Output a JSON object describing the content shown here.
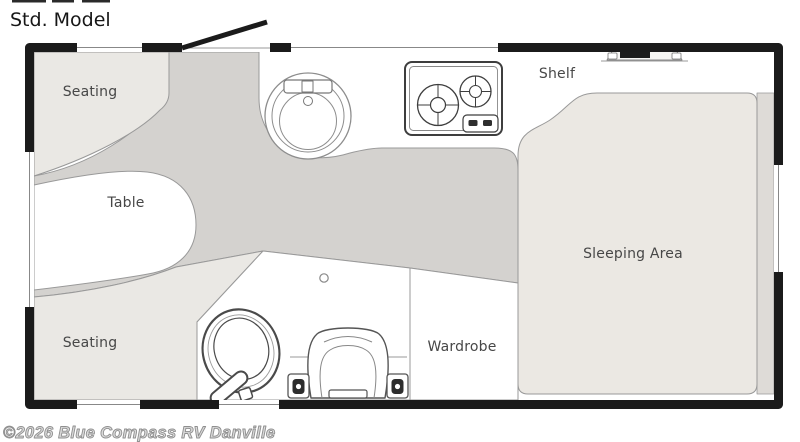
{
  "page_title": "Std. Model",
  "watermark": "©2026 Blue Compass RV Danville",
  "floorplan": {
    "rooms": {
      "seating_top": "Seating",
      "table": "Table",
      "seating_bottom": "Seating",
      "shelf": "Shelf",
      "wardrobe": "Wardrobe",
      "sleeping_area": "Sleeping Area"
    },
    "fixtures": {
      "entry_door": "entry-door",
      "kitchen_sink": "round-kitchen-sink",
      "cooktop": "two-burner-cooktop",
      "roof_vent": "roof-vent",
      "toilet": "toilet",
      "chair": "chair-seat",
      "windows": "window-openings"
    },
    "colors": {
      "wall": "#1b1b1b",
      "aisle_floor": "#d4d2cf",
      "furniture_light": "#eae8e4",
      "mattress": "#ebe8e3",
      "side_ledge": "#dedbd7",
      "white_area": "#ffffff",
      "outline": "#999999",
      "label_text": "#474747",
      "watermark_gray": "#9b9b9b"
    }
  }
}
